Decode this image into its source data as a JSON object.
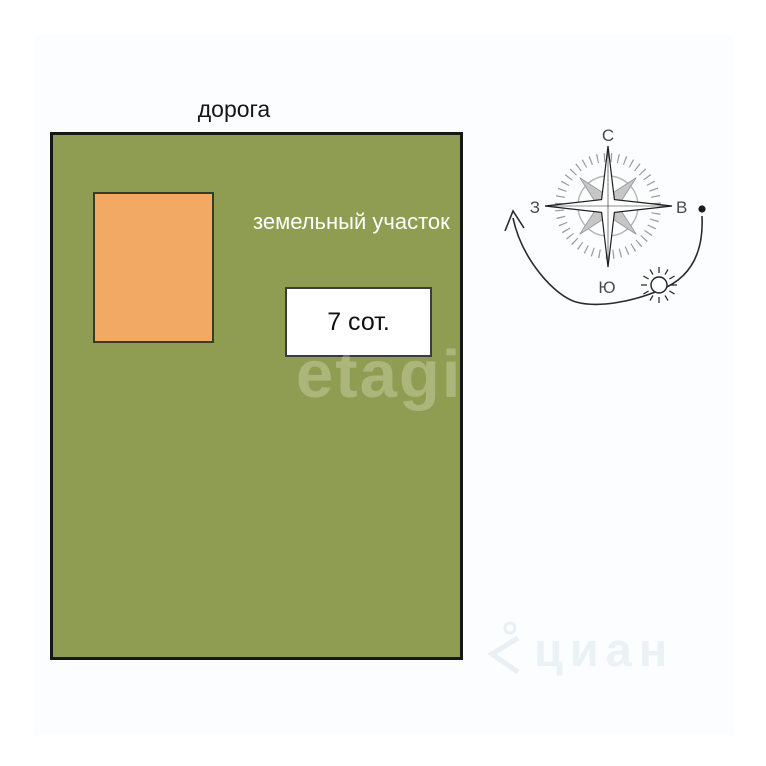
{
  "road": {
    "label": "дорога"
  },
  "plot": {
    "label": "земельный участок",
    "fill_color": "#8f9d52",
    "border_color": "#161616",
    "area_box": {
      "label": "7 сот."
    },
    "building": {
      "fill_color": "#f2a964"
    }
  },
  "compass": {
    "north": "С",
    "east": "В",
    "south": "Ю",
    "west": "З"
  },
  "watermarks": {
    "etagi": "etagi",
    "cian": "циан"
  }
}
